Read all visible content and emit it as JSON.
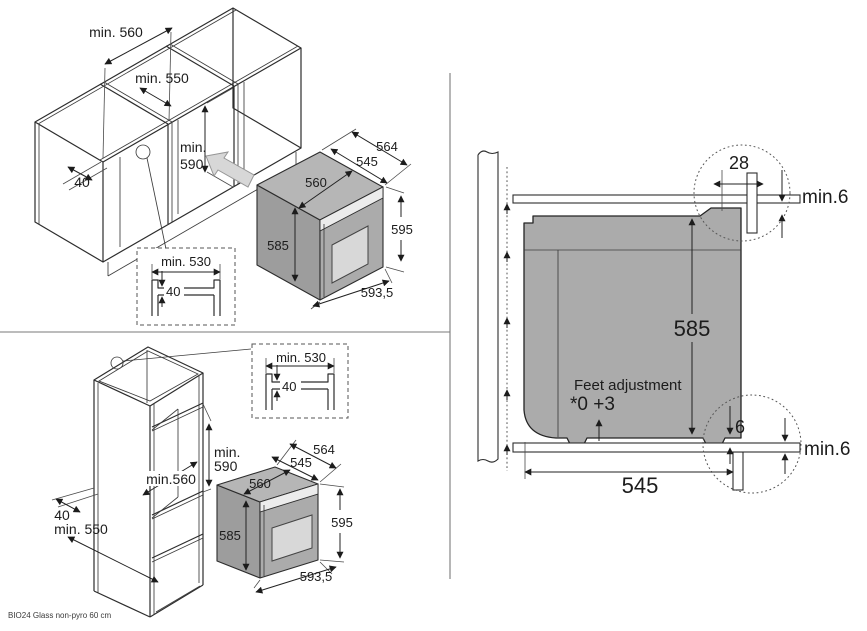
{
  "document": {
    "type": "built-in oven installation diagram",
    "footer_label": "BIO24 Glass non-pyro 60 cm"
  },
  "colors": {
    "line": "#2d2d2d",
    "oven_body_gray": "#ababab",
    "oven_top_gray": "#b6b6b6",
    "oven_side_gray": "#9d9d9d",
    "oven_window_gray": "#d8d8d8",
    "push_arrow_gray": "#d7d7d7",
    "background": "#ffffff"
  },
  "panel_undercounter": {
    "niche_width": "min. 560",
    "niche_depth": "min. 550",
    "niche_height_line1": "min.",
    "niche_height_line2": "590",
    "rail_width": "40",
    "inset": {
      "width": "min. 530",
      "rail_height": "40"
    },
    "oven": {
      "depth_total": "564",
      "depth_body": "545",
      "body_width": "560",
      "body_height": "585",
      "front_height": "595",
      "front_width": "593,5"
    }
  },
  "panel_tall": {
    "inset": {
      "width": "min. 530",
      "rail_height": "40"
    },
    "niche_height_line1": "min.",
    "niche_height_line2": "590",
    "niche_width": "min.560",
    "rail_width": "40",
    "niche_depth": "min. 550",
    "oven": {
      "depth_total": "564",
      "depth_body": "545",
      "body_width": "560",
      "body_height": "585",
      "front_height": "595",
      "front_width": "593,5"
    }
  },
  "panel_side": {
    "rear_top_gap": "28",
    "top_clearance": "min.6",
    "oven_height": "585",
    "feet_note_line1": "Feet adjustment",
    "feet_note_line2": "*0 +3",
    "rear_bottom_gap": "6",
    "bottom_clearance": "min.6",
    "depth": "545"
  }
}
